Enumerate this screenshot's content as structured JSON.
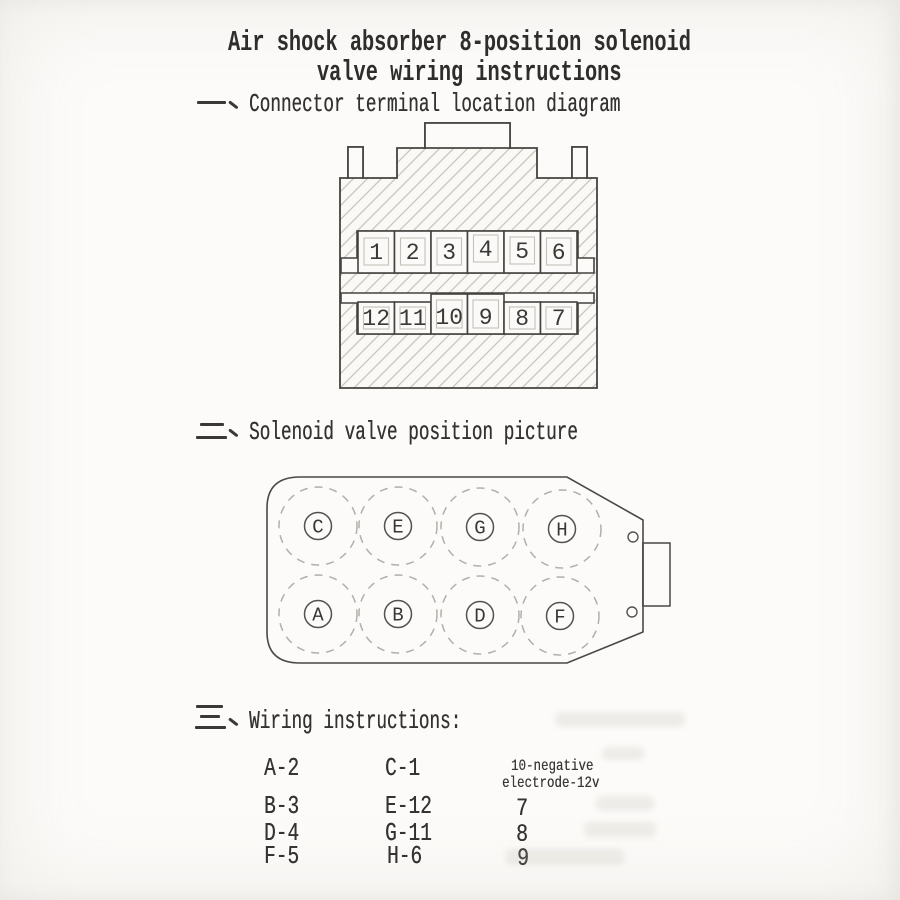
{
  "document": {
    "title_line1": "Air shock absorber 8-position solenoid",
    "title_line2": "valve wiring instructions"
  },
  "sections": [
    {
      "numeral": "一",
      "label": "Connector terminal location diagram"
    },
    {
      "numeral": "二",
      "label": "Solenoid valve position picture"
    },
    {
      "numeral": "三",
      "label": "Wiring instructions:"
    }
  ],
  "connector_diagram": {
    "top_row_terminals": [
      "1",
      "2",
      "3",
      "4",
      "5",
      "6"
    ],
    "bottom_row_terminals": [
      "12",
      "11",
      "10",
      "9",
      "8",
      "7"
    ]
  },
  "valve_diagram": {
    "top_row_ports": [
      "C",
      "E",
      "G",
      "H"
    ],
    "bottom_row_ports": [
      "A",
      "B",
      "D",
      "F"
    ]
  },
  "wiring_table": {
    "column1": [
      "A-2",
      "B-3",
      "D-4",
      "F-5"
    ],
    "column2": [
      "C-1",
      "E-12",
      "G-11",
      "H-6"
    ],
    "column3_header_line1": "10-negative",
    "column3_header_line2": "electrode-12v",
    "column3": [
      "7",
      "8",
      "9"
    ]
  },
  "colors": {
    "paper": "#fcfbf9",
    "ink": "#3c3c3c",
    "hatch_line": "#c9c5bf",
    "dashed_circle": "#b3aea7"
  }
}
